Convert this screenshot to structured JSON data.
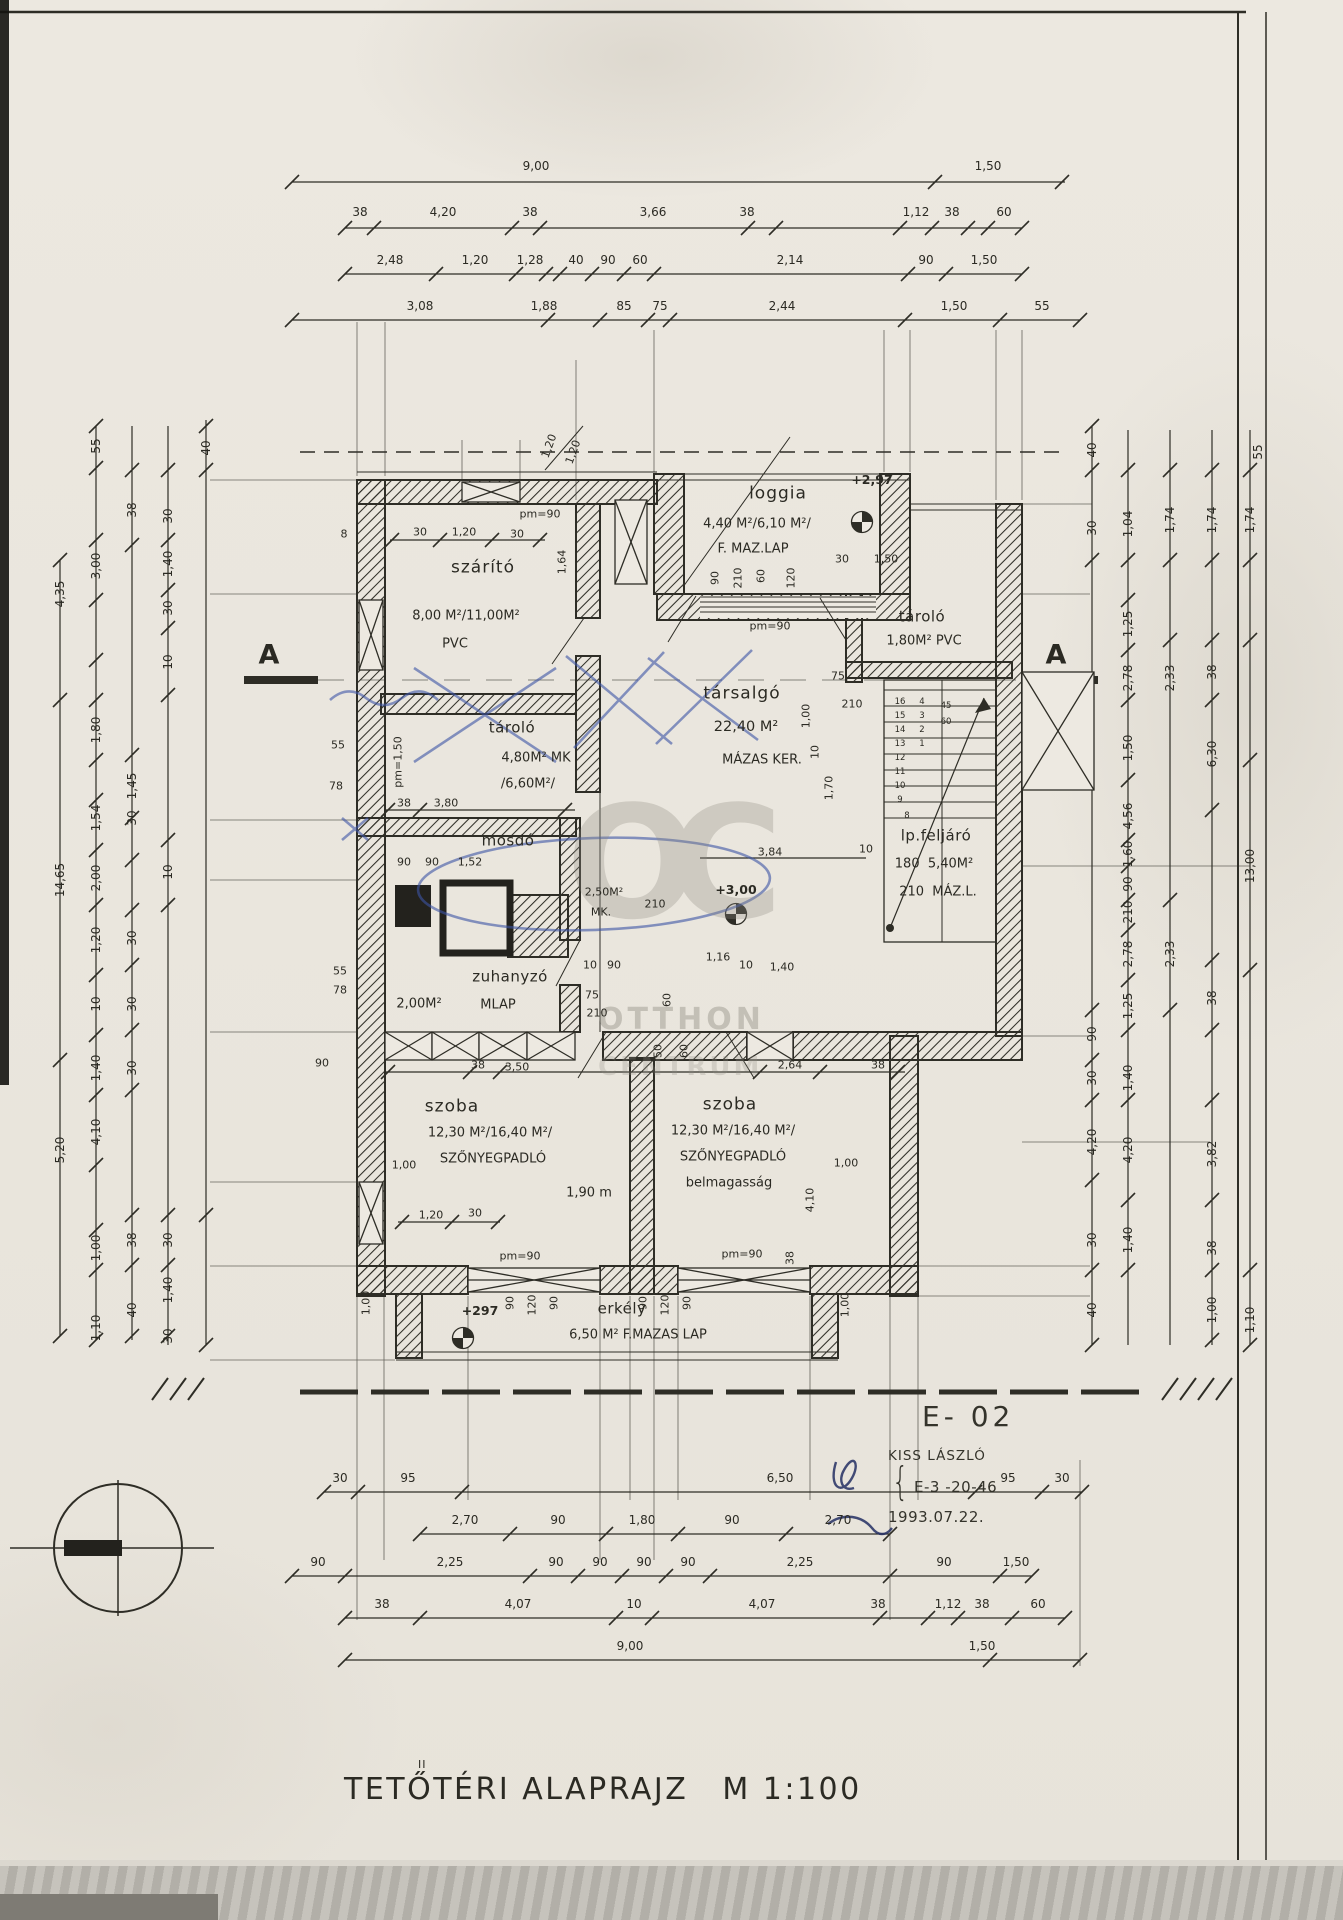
{
  "title": {
    "main": "TETŐTÉRI ALAPRAJZ",
    "scale": "M 1:100",
    "correction_mark": "II"
  },
  "title_block": {
    "code": "E- 02",
    "name": "KISS LÁSZLÓ",
    "brace": "{",
    "ref": "E-3 -20-46",
    "date": "1993.07.22."
  },
  "watermark": {
    "monogram": "OC",
    "line1": "OTTHON",
    "line2": "CENTRUM"
  },
  "sections": {
    "left": "A",
    "right": "A"
  },
  "dims": {
    "top_rows": [
      {
        "y": 166,
        "labels": [
          [
            536,
            "9,00"
          ],
          [
            988,
            "1,50"
          ]
        ]
      },
      {
        "y": 212,
        "labels": [
          [
            360,
            "38"
          ],
          [
            443,
            "4,20"
          ],
          [
            530,
            "38"
          ],
          [
            653,
            "3,66"
          ],
          [
            747,
            "38"
          ],
          [
            916,
            "1,12"
          ],
          [
            952,
            "38"
          ],
          [
            1004,
            "60"
          ]
        ]
      },
      {
        "y": 260,
        "labels": [
          [
            390,
            "2,48"
          ],
          [
            475,
            "1,20"
          ],
          [
            530,
            "1,28"
          ],
          [
            576,
            "40"
          ],
          [
            608,
            "90"
          ],
          [
            640,
            "60"
          ],
          [
            790,
            "2,14"
          ],
          [
            926,
            "90"
          ],
          [
            984,
            "1,50"
          ]
        ]
      },
      {
        "y": 306,
        "labels": [
          [
            420,
            "3,08"
          ],
          [
            544,
            "1,88"
          ],
          [
            624,
            "85"
          ],
          [
            660,
            "75"
          ],
          [
            782,
            "2,44"
          ],
          [
            954,
            "1,50"
          ],
          [
            1042,
            "55"
          ]
        ]
      }
    ],
    "bottom_rows": [
      {
        "y": 1478,
        "labels": [
          [
            340,
            "30"
          ],
          [
            408,
            "95"
          ],
          [
            780,
            "6,50"
          ],
          [
            1008,
            "95"
          ],
          [
            1062,
            "30"
          ]
        ]
      },
      {
        "y": 1520,
        "labels": [
          [
            465,
            "2,70"
          ],
          [
            558,
            "90"
          ],
          [
            642,
            "1,80"
          ],
          [
            732,
            "90"
          ],
          [
            838,
            "2,70"
          ]
        ]
      },
      {
        "y": 1562,
        "labels": [
          [
            318,
            "90"
          ],
          [
            450,
            "2,25"
          ],
          [
            556,
            "90"
          ],
          [
            600,
            "90"
          ],
          [
            644,
            "90"
          ],
          [
            688,
            "90"
          ],
          [
            800,
            "2,25"
          ],
          [
            944,
            "90"
          ],
          [
            1016,
            "1,50"
          ]
        ]
      },
      {
        "y": 1604,
        "labels": [
          [
            382,
            "38"
          ],
          [
            518,
            "4,07"
          ],
          [
            634,
            "10"
          ],
          [
            762,
            "4,07"
          ],
          [
            878,
            "38"
          ],
          [
            948,
            "1,12"
          ],
          [
            982,
            "38"
          ],
          [
            1038,
            "60"
          ]
        ]
      },
      {
        "y": 1646,
        "labels": [
          [
            630,
            "9,00"
          ],
          [
            982,
            "1,50"
          ]
        ]
      }
    ],
    "left_labels": [
      [
        96,
        446,
        "55"
      ],
      [
        132,
        510,
        "38"
      ],
      [
        206,
        448,
        "40"
      ],
      [
        168,
        516,
        "30"
      ],
      [
        168,
        564,
        "1,40"
      ],
      [
        168,
        608,
        "30"
      ],
      [
        96,
        566,
        "3,00"
      ],
      [
        60,
        594,
        "4,35"
      ],
      [
        168,
        662,
        "10"
      ],
      [
        96,
        730,
        "1,80"
      ],
      [
        132,
        786,
        "1,45"
      ],
      [
        60,
        880,
        "14,65"
      ],
      [
        96,
        818,
        "1,54"
      ],
      [
        132,
        818,
        "30"
      ],
      [
        96,
        878,
        "2,00"
      ],
      [
        168,
        872,
        "10"
      ],
      [
        96,
        940,
        "1,20"
      ],
      [
        132,
        938,
        "30"
      ],
      [
        96,
        1004,
        "10"
      ],
      [
        132,
        1004,
        "30"
      ],
      [
        96,
        1068,
        "1,40"
      ],
      [
        132,
        1068,
        "30"
      ],
      [
        96,
        1132,
        "4,10"
      ],
      [
        60,
        1150,
        "5,20"
      ],
      [
        132,
        1240,
        "38"
      ],
      [
        96,
        1248,
        "1,00"
      ],
      [
        132,
        1310,
        "40"
      ],
      [
        96,
        1328,
        "1,10"
      ],
      [
        168,
        1240,
        "30"
      ],
      [
        168,
        1290,
        "1,40"
      ],
      [
        168,
        1336,
        "30"
      ]
    ],
    "right_labels": [
      [
        1092,
        450,
        "40"
      ],
      [
        1092,
        528,
        "30"
      ],
      [
        1128,
        524,
        "1,04"
      ],
      [
        1170,
        520,
        "1,74"
      ],
      [
        1212,
        520,
        "1,74"
      ],
      [
        1250,
        520,
        "1,74"
      ],
      [
        1258,
        452,
        "55"
      ],
      [
        1128,
        624,
        "1,25"
      ],
      [
        1128,
        678,
        "2,78"
      ],
      [
        1170,
        678,
        "2,33"
      ],
      [
        1212,
        672,
        "38"
      ],
      [
        1128,
        748,
        "1,50"
      ],
      [
        1212,
        754,
        "6,30"
      ],
      [
        1128,
        816,
        "4,56"
      ],
      [
        1128,
        854,
        "1,60"
      ],
      [
        1128,
        884,
        "90"
      ],
      [
        1128,
        912,
        "210"
      ],
      [
        1250,
        866,
        "13,00"
      ],
      [
        1128,
        954,
        "2,78"
      ],
      [
        1170,
        954,
        "2,33"
      ],
      [
        1128,
        1006,
        "1,25"
      ],
      [
        1212,
        998,
        "38"
      ],
      [
        1092,
        1034,
        "90"
      ],
      [
        1092,
        1078,
        "30"
      ],
      [
        1128,
        1078,
        "1,40"
      ],
      [
        1092,
        1142,
        "4,20"
      ],
      [
        1128,
        1150,
        "4,20"
      ],
      [
        1212,
        1154,
        "3,82"
      ],
      [
        1092,
        1240,
        "30"
      ],
      [
        1128,
        1240,
        "1,40"
      ],
      [
        1212,
        1248,
        "38"
      ],
      [
        1212,
        1310,
        "1,00"
      ],
      [
        1250,
        1320,
        "1,10"
      ],
      [
        1092,
        1310,
        "40"
      ]
    ]
  },
  "plan_labels": [
    [
      483,
      568,
      "szárító",
      0,
      "rm"
    ],
    [
      466,
      616,
      "8,00 M²/11,00M²",
      0,
      "ar"
    ],
    [
      455,
      644,
      "PVC",
      0,
      "ar"
    ],
    [
      540,
      514,
      "pm=90",
      0,
      "sm"
    ],
    [
      344,
      534,
      "8",
      0,
      "sm"
    ],
    [
      420,
      532,
      "30",
      0,
      "sm"
    ],
    [
      464,
      532,
      "1,20",
      0,
      "sm"
    ],
    [
      517,
      534,
      "30",
      0,
      "sm"
    ],
    [
      562,
      562,
      "1,64",
      -90,
      "sm"
    ],
    [
      549,
      446,
      "1,20",
      -70,
      "sm"
    ],
    [
      573,
      452,
      "1,20",
      -70,
      "sm"
    ],
    [
      778,
      494,
      "loggia",
      0,
      "rm"
    ],
    [
      757,
      524,
      "4,40 M²/6,10 M²/",
      0,
      "ar"
    ],
    [
      753,
      549,
      "F. MAZ.LAP",
      0,
      "ar"
    ],
    [
      872,
      480,
      "+2,97",
      0,
      "el"
    ],
    [
      715,
      578,
      "90",
      -90,
      "sm"
    ],
    [
      738,
      578,
      "210",
      -90,
      "sm"
    ],
    [
      761,
      576,
      "60",
      -90,
      "sm"
    ],
    [
      791,
      578,
      "120",
      -90,
      "sm"
    ],
    [
      842,
      559,
      "30",
      0,
      "sm"
    ],
    [
      886,
      559,
      "1,50",
      0,
      "sm"
    ],
    [
      922,
      617,
      "tároló",
      0,
      "rm2"
    ],
    [
      924,
      641,
      "1,80M² PVC",
      0,
      "ar"
    ],
    [
      770,
      626,
      "pm=90",
      0,
      "sm"
    ],
    [
      838,
      676,
      "75",
      0,
      "sm"
    ],
    [
      852,
      704,
      "210",
      0,
      "sm"
    ],
    [
      806,
      716,
      "1,00",
      -90,
      "sm"
    ],
    [
      815,
      752,
      "10",
      -90,
      "sm"
    ],
    [
      829,
      788,
      "1,70",
      -90,
      "sm"
    ],
    [
      742,
      694,
      "társalgó",
      0,
      "rm"
    ],
    [
      746,
      727,
      "22,40 M²",
      0,
      "ar2"
    ],
    [
      762,
      760,
      "MÁZAS KER.",
      0,
      "ar"
    ],
    [
      770,
      852,
      "3,84",
      0,
      "sm"
    ],
    [
      866,
      849,
      "10",
      0,
      "sm"
    ],
    [
      512,
      728,
      "tároló",
      0,
      "rm2"
    ],
    [
      536,
      758,
      "4,80M² MK",
      0,
      "ar"
    ],
    [
      528,
      784,
      "/6,60M²/",
      0,
      "ar"
    ],
    [
      398,
      762,
      "pm=1,50",
      -90,
      "sm"
    ],
    [
      404,
      803,
      "38",
      0,
      "sm"
    ],
    [
      446,
      803,
      "3,80",
      0,
      "sm"
    ],
    [
      338,
      745,
      "55",
      0,
      "sm"
    ],
    [
      336,
      786,
      "78",
      0,
      "sm"
    ],
    [
      508,
      841,
      "mosdó",
      0,
      "rm2"
    ],
    [
      404,
      862,
      "90",
      0,
      "sm"
    ],
    [
      432,
      862,
      "90",
      0,
      "sm"
    ],
    [
      470,
      862,
      "1,52",
      0,
      "sm"
    ],
    [
      604,
      892,
      "2,50M²",
      0,
      "sm"
    ],
    [
      601,
      912,
      "MK.",
      0,
      "sm"
    ],
    [
      655,
      904,
      "210",
      0,
      "sm"
    ],
    [
      736,
      890,
      "+3,00",
      0,
      "el"
    ],
    [
      510,
      977,
      "zuhanyzó",
      0,
      "rm2"
    ],
    [
      419,
      1004,
      "2,00M²",
      0,
      "ar"
    ],
    [
      498,
      1005,
      "MLAP",
      0,
      "ar"
    ],
    [
      340,
      971,
      "55",
      0,
      "sm"
    ],
    [
      340,
      990,
      "78",
      0,
      "sm"
    ],
    [
      718,
      957,
      "1,16",
      0,
      "sm"
    ],
    [
      590,
      965,
      "10",
      0,
      "sm"
    ],
    [
      614,
      965,
      "90",
      0,
      "sm"
    ],
    [
      746,
      965,
      "10",
      0,
      "sm"
    ],
    [
      782,
      967,
      "1,40",
      0,
      "sm"
    ],
    [
      592,
      995,
      "75",
      0,
      "sm"
    ],
    [
      597,
      1013,
      "210",
      0,
      "sm"
    ],
    [
      667,
      1000,
      "60",
      -90,
      "sm"
    ],
    [
      936,
      836,
      "lp.feljáró",
      0,
      "rm2"
    ],
    [
      934,
      864,
      "180  5,40M²",
      0,
      "ar"
    ],
    [
      938,
      892,
      "210  MÁZ.L.",
      0,
      "ar"
    ],
    [
      322,
      1063,
      "90",
      0,
      "sm"
    ],
    [
      478,
      1065,
      "38",
      0,
      "sm"
    ],
    [
      517,
      1067,
      "3,50",
      0,
      "sm"
    ],
    [
      790,
      1065,
      "2,64",
      0,
      "sm"
    ],
    [
      878,
      1065,
      "38",
      0,
      "sm"
    ],
    [
      658,
      1051,
      "50",
      -90,
      "sm"
    ],
    [
      684,
      1051,
      "60",
      -90,
      "sm"
    ],
    [
      452,
      1107,
      "szoba",
      0,
      "rm"
    ],
    [
      490,
      1133,
      "12,30 M²/16,40 M²/",
      0,
      "ar"
    ],
    [
      493,
      1159,
      "SZŐNYEGPADLÓ",
      0,
      "ar"
    ],
    [
      404,
      1165,
      "1,00",
      0,
      "sm"
    ],
    [
      589,
      1193,
      "1,90 m",
      0,
      "ar"
    ],
    [
      431,
      1215,
      "1,20",
      0,
      "sm"
    ],
    [
      475,
      1213,
      "30",
      0,
      "sm"
    ],
    [
      730,
      1105,
      "szoba",
      0,
      "rm"
    ],
    [
      733,
      1131,
      "12,30 M²/16,40 M²/",
      0,
      "ar"
    ],
    [
      733,
      1157,
      "SZŐNYEGPADLÓ",
      0,
      "ar"
    ],
    [
      729,
      1183,
      "belmagasság",
      0,
      "ar"
    ],
    [
      846,
      1163,
      "1,00",
      0,
      "sm"
    ],
    [
      810,
      1200,
      "4,10",
      -90,
      "sm"
    ],
    [
      520,
      1256,
      "pm=90",
      0,
      "sm"
    ],
    [
      742,
      1254,
      "pm=90",
      0,
      "sm"
    ],
    [
      790,
      1258,
      "38",
      -90,
      "sm"
    ],
    [
      480,
      1311,
      "+297",
      0,
      "el"
    ],
    [
      622,
      1309,
      "erkély",
      0,
      "rm2"
    ],
    [
      638,
      1335,
      "6,50 M² F.MAZAS LAP",
      0,
      "ar"
    ],
    [
      510,
      1303,
      "90",
      -90,
      "sm"
    ],
    [
      532,
      1305,
      "120",
      -90,
      "sm"
    ],
    [
      554,
      1303,
      "90",
      -90,
      "sm"
    ],
    [
      643,
      1303,
      "90",
      -90,
      "sm"
    ],
    [
      665,
      1305,
      "120",
      -90,
      "sm"
    ],
    [
      687,
      1303,
      "90",
      -90,
      "sm"
    ],
    [
      366,
      1303,
      "1,00",
      -90,
      "sm"
    ],
    [
      845,
      1305,
      "1,00",
      -90,
      "sm"
    ],
    [
      900,
      702,
      "16",
      0,
      "st"
    ],
    [
      900,
      716,
      "15",
      0,
      "st"
    ],
    [
      900,
      730,
      "14",
      0,
      "st"
    ],
    [
      900,
      744,
      "13",
      0,
      "st"
    ],
    [
      900,
      758,
      "12",
      0,
      "st"
    ],
    [
      900,
      772,
      "11",
      0,
      "st"
    ],
    [
      900,
      786,
      "10",
      0,
      "st"
    ],
    [
      900,
      800,
      "9",
      0,
      "st"
    ],
    [
      907,
      816,
      "8",
      0,
      "st"
    ],
    [
      922,
      702,
      "4",
      0,
      "st"
    ],
    [
      922,
      716,
      "3",
      0,
      "st"
    ],
    [
      922,
      730,
      "2",
      0,
      "st"
    ],
    [
      922,
      744,
      "1",
      0,
      "st"
    ],
    [
      946,
      706,
      "45",
      0,
      "st"
    ],
    [
      946,
      722,
      "60",
      0,
      "st"
    ]
  ]
}
